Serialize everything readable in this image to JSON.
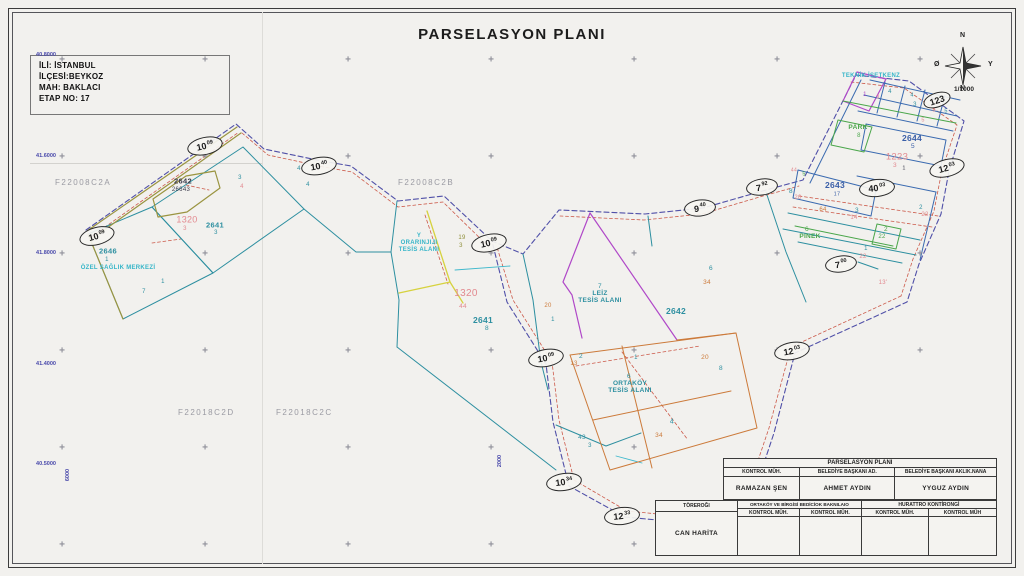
{
  "title": "PARSELASYON PLANI",
  "info_box": {
    "lines": [
      "İLİ: İSTANBUL",
      "İLÇESİ:BEYKOZ",
      "MAH: BAKLACI",
      "ETAP NO: 17"
    ]
  },
  "compass": {
    "north": "N",
    "south": "N",
    "east": "Y",
    "west": "Ø",
    "scale": "1/1000"
  },
  "colors": {
    "pink": "#e2898f",
    "teal": "#2d8fa0",
    "cyan": "#35b5c8",
    "blue": "#3a5fa8",
    "green": "#4aa64a",
    "orange": "#cc7a3a",
    "olive": "#8f8f3a",
    "dark": "#3a3a4a",
    "magenta": "#b048c8"
  },
  "sheet_labels": [
    {
      "t": "F22008C2A",
      "x": 55,
      "y": 178
    },
    {
      "t": "F22008C2B",
      "x": 398,
      "y": 178
    },
    {
      "t": "F22018C2D",
      "x": 178,
      "y": 408
    },
    {
      "t": "F22018C2C",
      "x": 276,
      "y": 408
    }
  ],
  "coord_labels": [
    {
      "t": "40.8000",
      "x": 34,
      "y": 52,
      "r": 0
    },
    {
      "t": "41.6000",
      "x": 34,
      "y": 153,
      "r": 0
    },
    {
      "t": "41.8000",
      "x": 34,
      "y": 250,
      "r": 0
    },
    {
      "t": "41.4000",
      "x": 34,
      "y": 361,
      "r": 0
    },
    {
      "t": "40.5000",
      "x": 34,
      "y": 461,
      "r": 0
    },
    {
      "t": "6000",
      "x": 56,
      "y": 472,
      "r": -90
    },
    {
      "t": "2000",
      "x": 488,
      "y": 458,
      "r": -90
    }
  ],
  "grid": {
    "cross_xs": [
      62,
      205,
      348,
      491,
      634,
      777,
      920
    ],
    "cross_ys": [
      60,
      157,
      254,
      351,
      448,
      545
    ]
  },
  "ellipse_labels": [
    {
      "m": "10",
      "s": "09",
      "x": 205,
      "y": 146,
      "r": -12,
      "w": 34,
      "h": 16
    },
    {
      "m": "10",
      "s": "40",
      "x": 319,
      "y": 166,
      "r": -10,
      "w": 34,
      "h": 16
    },
    {
      "m": "10",
      "s": "09",
      "x": 97,
      "y": 236,
      "r": -15,
      "w": 34,
      "h": 16
    },
    {
      "m": "10",
      "s": "09",
      "x": 489,
      "y": 243,
      "r": -12,
      "w": 34,
      "h": 16
    },
    {
      "m": "10",
      "s": "09",
      "x": 546,
      "y": 358,
      "r": -10,
      "w": 34,
      "h": 16
    },
    {
      "m": "10",
      "s": "34",
      "x": 564,
      "y": 482,
      "r": -8,
      "w": 34,
      "h": 16
    },
    {
      "m": "12",
      "s": "33",
      "x": 622,
      "y": 516,
      "r": -6,
      "w": 34,
      "h": 16
    },
    {
      "m": "12",
      "s": "03",
      "x": 792,
      "y": 351,
      "r": -10,
      "w": 34,
      "h": 16
    },
    {
      "m": "9",
      "s": "40",
      "x": 700,
      "y": 208,
      "r": -6,
      "w": 30,
      "h": 15
    },
    {
      "m": "7",
      "s": "92",
      "x": 762,
      "y": 187,
      "r": -8,
      "w": 30,
      "h": 15
    },
    {
      "m": "40",
      "s": "03",
      "x": 877,
      "y": 188,
      "r": -6,
      "w": 34,
      "h": 16
    },
    {
      "m": "7",
      "s": "00",
      "x": 841,
      "y": 264,
      "r": -8,
      "w": 30,
      "h": 15
    },
    {
      "m": "12",
      "s": "03",
      "x": 947,
      "y": 168,
      "r": -14,
      "w": 34,
      "h": 16
    },
    {
      "m": "123",
      "s": "",
      "x": 937,
      "y": 100,
      "r": -18,
      "w": 26,
      "h": 13
    }
  ],
  "map_labels": [
    {
      "t": "2642",
      "x": 183,
      "y": 181,
      "c": "dark",
      "fs": 7.5,
      "b": 1
    },
    {
      "t": "26643",
      "x": 181,
      "y": 190,
      "c": "dark",
      "fs": 6
    },
    {
      "t": "1320",
      "x": 187,
      "y": 220,
      "c": "pink",
      "fs": 9
    },
    {
      "t": "3",
      "x": 185,
      "y": 229,
      "c": "pink",
      "fs": 6
    },
    {
      "t": "2641",
      "x": 215,
      "y": 225,
      "c": "teal",
      "fs": 7.5,
      "b": 1
    },
    {
      "t": "3",
      "x": 216,
      "y": 233,
      "c": "teal",
      "fs": 6
    },
    {
      "t": "3",
      "x": 240,
      "y": 178,
      "c": "teal",
      "fs": 6
    },
    {
      "t": "4",
      "x": 242,
      "y": 187,
      "c": "pink",
      "fs": 6
    },
    {
      "t": "4",
      "x": 299,
      "y": 169,
      "c": "teal",
      "fs": 6
    },
    {
      "t": "4",
      "x": 308,
      "y": 185,
      "c": "teal",
      "fs": 6
    },
    {
      "t": "2646",
      "x": 108,
      "y": 251,
      "c": "teal",
      "fs": 7.5,
      "b": 1
    },
    {
      "t": "1",
      "x": 107,
      "y": 260,
      "c": "teal",
      "fs": 6
    },
    {
      "t": "ÖZEL SAĞLIK MERKEZİ",
      "x": 118,
      "y": 268,
      "c": "cyan",
      "fs": 6,
      "b": 1
    },
    {
      "t": "1",
      "x": 163,
      "y": 282,
      "c": "teal",
      "fs": 6
    },
    {
      "t": "7",
      "x": 144,
      "y": 292,
      "c": "teal",
      "fs": 6
    },
    {
      "t": "Y",
      "x": 419,
      "y": 236,
      "c": "cyan",
      "fs": 6,
      "b": 1
    },
    {
      "t": "ORARINJIJI",
      "x": 419,
      "y": 243,
      "c": "cyan",
      "fs": 6,
      "b": 1
    },
    {
      "t": "TESİS ALANI",
      "x": 419,
      "y": 250,
      "c": "cyan",
      "fs": 6,
      "b": 1
    },
    {
      "t": "19",
      "x": 462,
      "y": 238,
      "c": "olive",
      "fs": 6
    },
    {
      "t": "3",
      "x": 461,
      "y": 246,
      "c": "olive",
      "fs": 6
    },
    {
      "t": "1320",
      "x": 466,
      "y": 294,
      "c": "pink",
      "fs": 10
    },
    {
      "t": "44",
      "x": 463,
      "y": 307,
      "c": "pink",
      "fs": 6.5
    },
    {
      "t": "2641",
      "x": 483,
      "y": 320,
      "c": "teal",
      "fs": 8.5,
      "b": 1
    },
    {
      "t": "8",
      "x": 487,
      "y": 329,
      "c": "teal",
      "fs": 6.5
    },
    {
      "t": "20",
      "x": 548,
      "y": 306,
      "c": "orange",
      "fs": 6
    },
    {
      "t": "1",
      "x": 553,
      "y": 320,
      "c": "teal",
      "fs": 6
    },
    {
      "t": "7",
      "x": 600,
      "y": 287,
      "c": "teal",
      "fs": 6.5
    },
    {
      "t": "LEİZ",
      "x": 600,
      "y": 294,
      "c": "teal",
      "fs": 6.5,
      "b": 1
    },
    {
      "t": "TESİS ALANI",
      "x": 600,
      "y": 301,
      "c": "teal",
      "fs": 6.5,
      "b": 1
    },
    {
      "t": "2642",
      "x": 676,
      "y": 311,
      "c": "teal",
      "fs": 8.5,
      "b": 1
    },
    {
      "t": "6",
      "x": 711,
      "y": 269,
      "c": "teal",
      "fs": 6.5
    },
    {
      "t": "34",
      "x": 707,
      "y": 283,
      "c": "orange",
      "fs": 6.5
    },
    {
      "t": "2",
      "x": 581,
      "y": 357,
      "c": "teal",
      "fs": 6.5
    },
    {
      "t": "13",
      "x": 574,
      "y": 364,
      "c": "orange",
      "fs": 6
    },
    {
      "t": "1",
      "x": 636,
      "y": 358,
      "c": "teal",
      "fs": 6
    },
    {
      "t": "20",
      "x": 705,
      "y": 358,
      "c": "orange",
      "fs": 6.5
    },
    {
      "t": "8",
      "x": 721,
      "y": 369,
      "c": "teal",
      "fs": 6.5
    },
    {
      "t": "6",
      "x": 629,
      "y": 377,
      "c": "teal",
      "fs": 6.5
    },
    {
      "t": "ORTAKÖY",
      "x": 630,
      "y": 384,
      "c": "teal",
      "fs": 6.5,
      "b": 1
    },
    {
      "t": "TESİS ALANI",
      "x": 630,
      "y": 391,
      "c": "teal",
      "fs": 6.5,
      "b": 1
    },
    {
      "t": "4",
      "x": 672,
      "y": 422,
      "c": "teal",
      "fs": 7
    },
    {
      "t": "34",
      "x": 659,
      "y": 436,
      "c": "orange",
      "fs": 6.5
    },
    {
      "t": "43",
      "x": 582,
      "y": 438,
      "c": "teal",
      "fs": 6.5
    },
    {
      "t": "3",
      "x": 590,
      "y": 446,
      "c": "teal",
      "fs": 6
    },
    {
      "t": "TEKNİK İSETKENZ",
      "x": 871,
      "y": 76,
      "c": "cyan",
      "fs": 6,
      "b": 1
    },
    {
      "t": "1",
      "x": 865,
      "y": 95,
      "c": "magenta",
      "fs": 6
    },
    {
      "t": "3",
      "x": 878,
      "y": 98,
      "c": "pink",
      "fs": 5.5
    },
    {
      "t": "4",
      "x": 890,
      "y": 92,
      "c": "teal",
      "fs": 6
    },
    {
      "t": "4",
      "x": 912,
      "y": 96,
      "c": "teal",
      "fs": 5.5
    },
    {
      "t": "3",
      "x": 915,
      "y": 105,
      "c": "teal",
      "fs": 6
    },
    {
      "t": "8",
      "x": 934,
      "y": 111,
      "c": "pink",
      "fs": 5.5
    },
    {
      "t": "5",
      "x": 946,
      "y": 112,
      "c": "teal",
      "fs": 5.5
    },
    {
      "t": "5",
      "x": 923,
      "y": 121,
      "c": "pink",
      "fs": 5.5
    },
    {
      "t": "PARK",
      "x": 858,
      "y": 128,
      "c": "green",
      "fs": 6.5,
      "b": 1
    },
    {
      "t": "8",
      "x": 859,
      "y": 136,
      "c": "green",
      "fs": 6
    },
    {
      "t": "2644",
      "x": 912,
      "y": 138,
      "c": "blue",
      "fs": 8.5,
      "b": 1
    },
    {
      "t": "5",
      "x": 913,
      "y": 147,
      "c": "blue",
      "fs": 6.5
    },
    {
      "t": "1223",
      "x": 897,
      "y": 157,
      "c": "pink",
      "fs": 9.5
    },
    {
      "t": "3",
      "x": 895,
      "y": 166,
      "c": "pink",
      "fs": 6.5
    },
    {
      "t": "1",
      "x": 904,
      "y": 169,
      "c": "dark",
      "fs": 5.5
    },
    {
      "t": "2643",
      "x": 835,
      "y": 185,
      "c": "blue",
      "fs": 8.5,
      "b": 1
    },
    {
      "t": "17",
      "x": 837,
      "y": 195,
      "c": "blue",
      "fs": 5.5
    },
    {
      "t": "8",
      "x": 791,
      "y": 192,
      "c": "teal",
      "fs": 6.5
    },
    {
      "t": "20",
      "x": 798,
      "y": 198,
      "c": "pink",
      "fs": 6
    },
    {
      "t": "44",
      "x": 794,
      "y": 171,
      "c": "pink",
      "fs": 5
    },
    {
      "t": "5",
      "x": 804,
      "y": 175,
      "c": "green",
      "fs": 5.5
    },
    {
      "t": "64",
      "x": 823,
      "y": 210,
      "c": "orange",
      "fs": 6
    },
    {
      "t": "3",
      "x": 857,
      "y": 211,
      "c": "teal",
      "fs": 6.5
    },
    {
      "t": "14",
      "x": 854,
      "y": 218,
      "c": "pink",
      "fs": 6
    },
    {
      "t": "6",
      "x": 807,
      "y": 230,
      "c": "green",
      "fs": 6.5
    },
    {
      "t": "PINEK",
      "x": 810,
      "y": 237,
      "c": "green",
      "fs": 6.5,
      "b": 1
    },
    {
      "t": "2",
      "x": 886,
      "y": 230,
      "c": "green",
      "fs": 6.5
    },
    {
      "t": "22",
      "x": 882,
      "y": 237,
      "c": "green",
      "fs": 6
    },
    {
      "t": "1",
      "x": 866,
      "y": 249,
      "c": "teal",
      "fs": 6
    },
    {
      "t": "22",
      "x": 863,
      "y": 257,
      "c": "pink",
      "fs": 6
    },
    {
      "t": "2",
      "x": 921,
      "y": 208,
      "c": "teal",
      "fs": 6
    },
    {
      "t": "22",
      "x": 925,
      "y": 215,
      "c": "pink",
      "fs": 6
    },
    {
      "t": "13'",
      "x": 883,
      "y": 283,
      "c": "pink",
      "fs": 6
    }
  ],
  "title_block": {
    "plan_title": "PARSELASYON PLANI",
    "upper_headers": [
      "KONTROL MÜH.",
      "BELEDİYE BAŞKANI AD.",
      "BELEDİYE BAŞKANI AKLIK.NANA"
    ],
    "upper_names": [
      "RAMAZAN ŞEN",
      "AHMET AYDIN",
      "YYGUZ AYDIN"
    ],
    "lower_left_header": "TÖREROĞI",
    "lower_left_name": "CAN HARİTA",
    "lower_mid_header": "ORTAKÖY VE BİRGİSİ BEDİCİOK BAKNILAIO",
    "lower_right_header": "HURATTRO KONTİRONGİ",
    "lower_sub_headers": [
      "KONTROL MÜH.",
      "KONTROL MÜH.",
      "KONTROL MÜH.",
      "KONTROL MÜH"
    ]
  }
}
